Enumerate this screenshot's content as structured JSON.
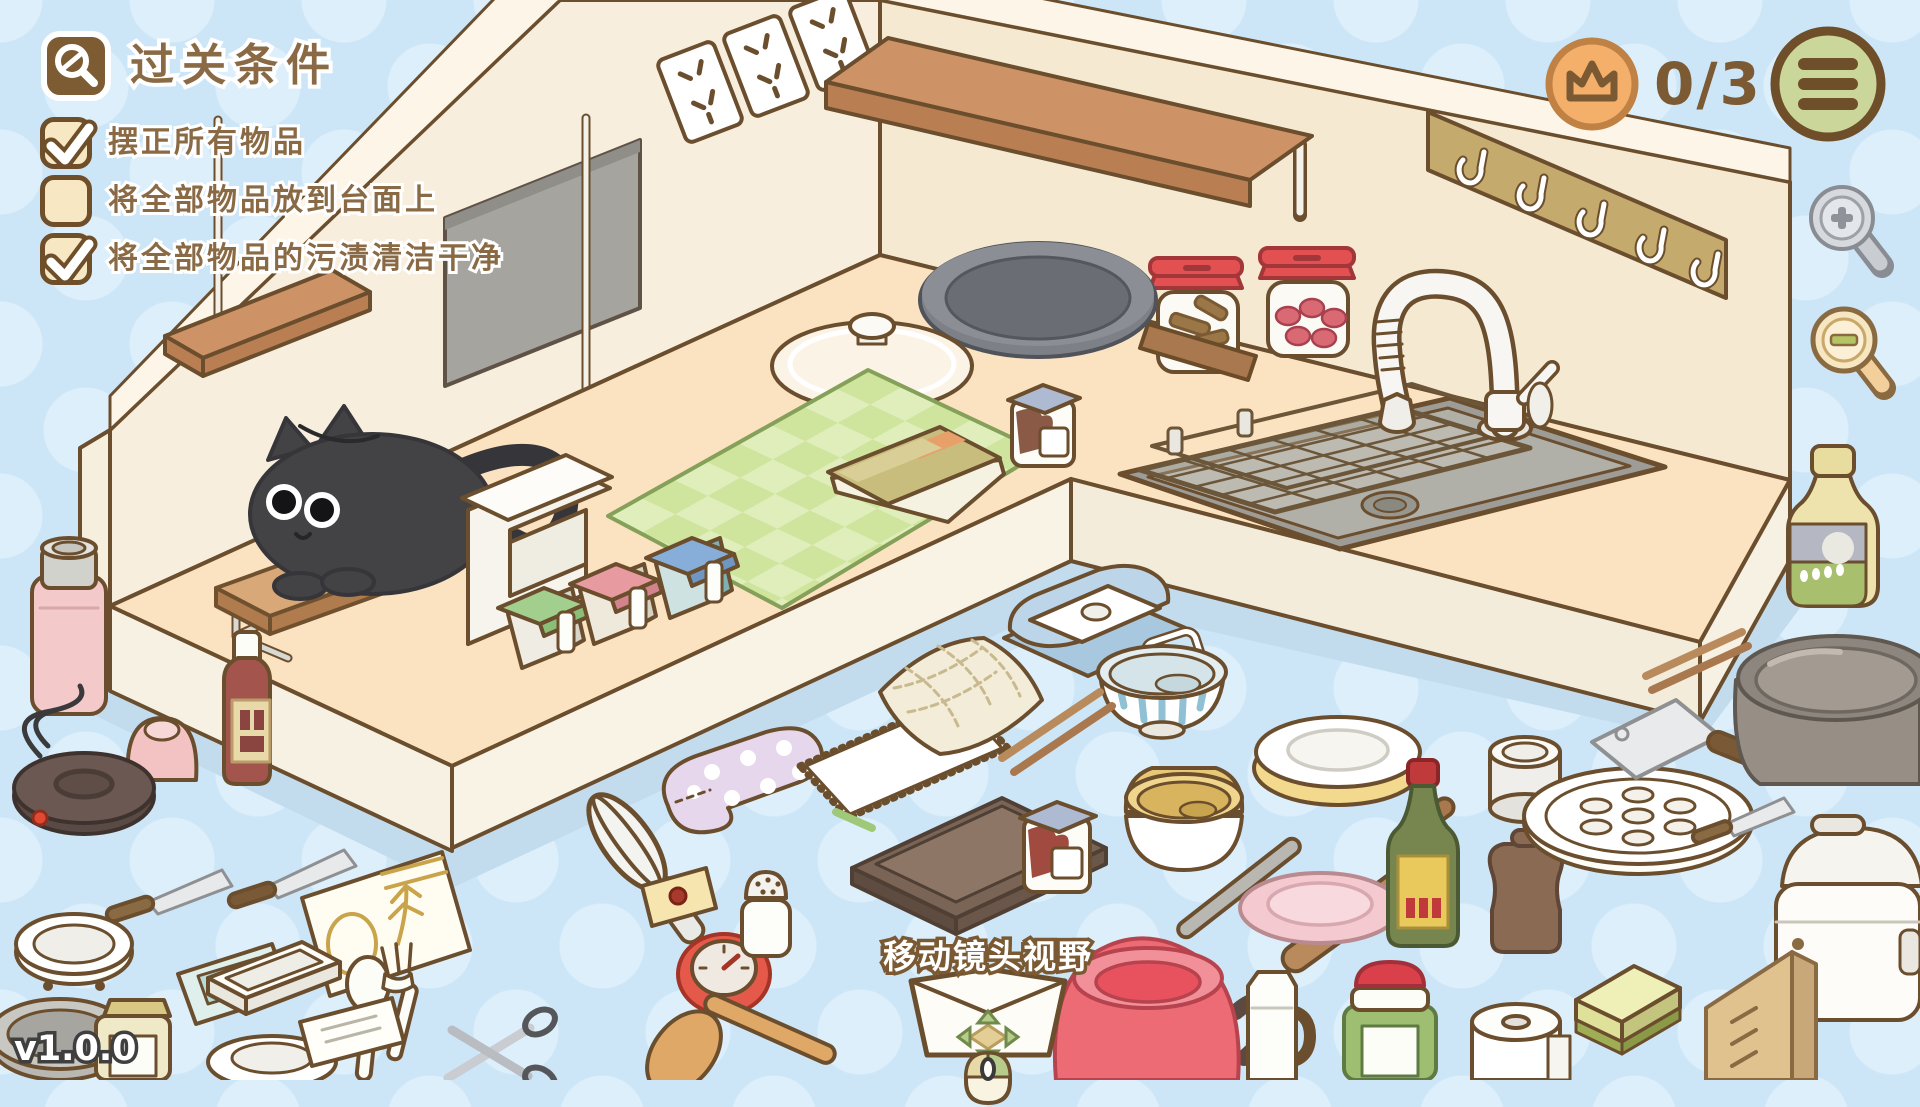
{
  "quest_panel": {
    "title": "过关条件",
    "icon": "magnifier-check-icon",
    "conditions": [
      {
        "label": "摆正所有物品",
        "checked": true
      },
      {
        "label": "将全部物品放到台面上",
        "checked": false
      },
      {
        "label": "将全部物品的污渍清洁干净",
        "checked": true
      }
    ]
  },
  "hud": {
    "crown_progress": {
      "icon": "crown-icon",
      "value": "0/3"
    },
    "menu": {
      "icon": "hamburger-icon"
    },
    "zoom_in": {
      "icon": "zoom-in-magnifier-icon"
    },
    "zoom_out": {
      "icon": "zoom-out-magnifier-icon"
    }
  },
  "camera_hint": {
    "label": "移动镜头视野",
    "icon": "mouse-drag-icon"
  },
  "version": "v1.0.0",
  "colors": {
    "background": "#cde6f7",
    "background_dot": "#dceffb",
    "outline_brown": "#6b4e2d",
    "text_brown": "#8a6a45",
    "checkbox_cream": "#f7e7c3",
    "crown_orange": "#f4b06a",
    "menu_green": "#cbd79a",
    "wall_cream": "#f8eedd",
    "counter_top": "#fbe2c0",
    "counter_face": "#f7f1e3",
    "mat_green": "#cfe49d",
    "kettle_red": "#ed6b74",
    "jar_lid_red": "#e25052",
    "cat_gray": "#434346"
  },
  "scene": {
    "items": [
      "black-cat",
      "cutting-board",
      "wire-stand",
      "wall-shelf-plank",
      "hanging-rod",
      "blackboard",
      "power-outlets",
      "wooden-wall-shelf",
      "hook-rack",
      "napkin-stand",
      "seasoning-box-green",
      "seasoning-box-pink",
      "seasoning-box-blue",
      "green-checkered-mat",
      "recipe-book",
      "pot-lid",
      "frying-pan",
      "cinnamon-jar",
      "candy-jar",
      "jam-jar",
      "sink",
      "drain-basket",
      "faucet",
      "thermos",
      "pudding-cup",
      "sauce-bottle",
      "electric-hot-plate",
      "kitchen-knife",
      "paring-knife",
      "seed-packet-teal",
      "seed-packet-wheat",
      "strainer-bowl",
      "white-tray",
      "soup-spoon",
      "fork",
      "small-plate",
      "mustard-jar",
      "postcard",
      "scissors",
      "whisk",
      "sticky-note",
      "kitchen-timer",
      "wooden-spatula",
      "salt-shaker",
      "oven-mitt",
      "white-dish-towel",
      "checkered-dish-towel",
      "baking-tray",
      "ladle",
      "rolling-pin",
      "butter-dish",
      "striped-bowl",
      "plate-stack",
      "stacked-bowls",
      "pink-plate",
      "chopsticks",
      "jam-jar-small",
      "red-kettle",
      "milk-jug",
      "pickle-jar",
      "vinegar-bottle",
      "tin-can",
      "pepper-mill",
      "steamer-plate",
      "cleaver",
      "inner-pot",
      "chopsticks-pair",
      "oil-bottle",
      "rice-cooker",
      "paper-roll",
      "sponge",
      "knife-block"
    ]
  }
}
